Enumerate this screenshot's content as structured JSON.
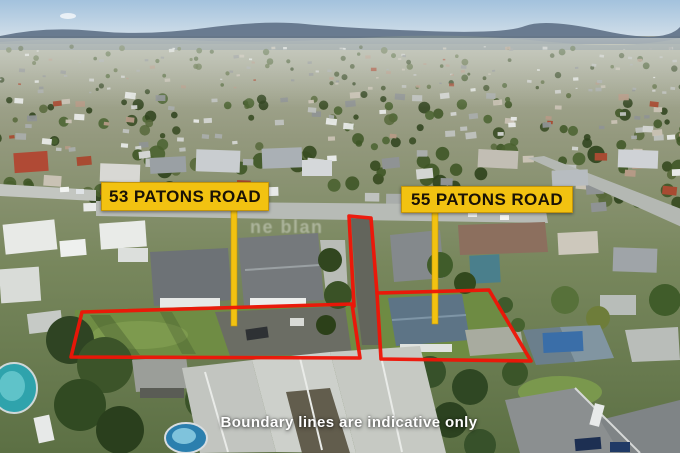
{
  "overlay": {
    "property_labels": [
      {
        "id": "53",
        "text": "53 PATONS ROAD"
      },
      {
        "id": "55",
        "text": "55 PATONS ROAD"
      }
    ],
    "disclaimer": "Boundary lines are indicative only",
    "watermark": "ne blan",
    "colors": {
      "label_bg": "#F2C211",
      "label_text": "#1A1206",
      "boundary": "#EE1507",
      "disclaimer_text": "#FFFFFF"
    }
  }
}
